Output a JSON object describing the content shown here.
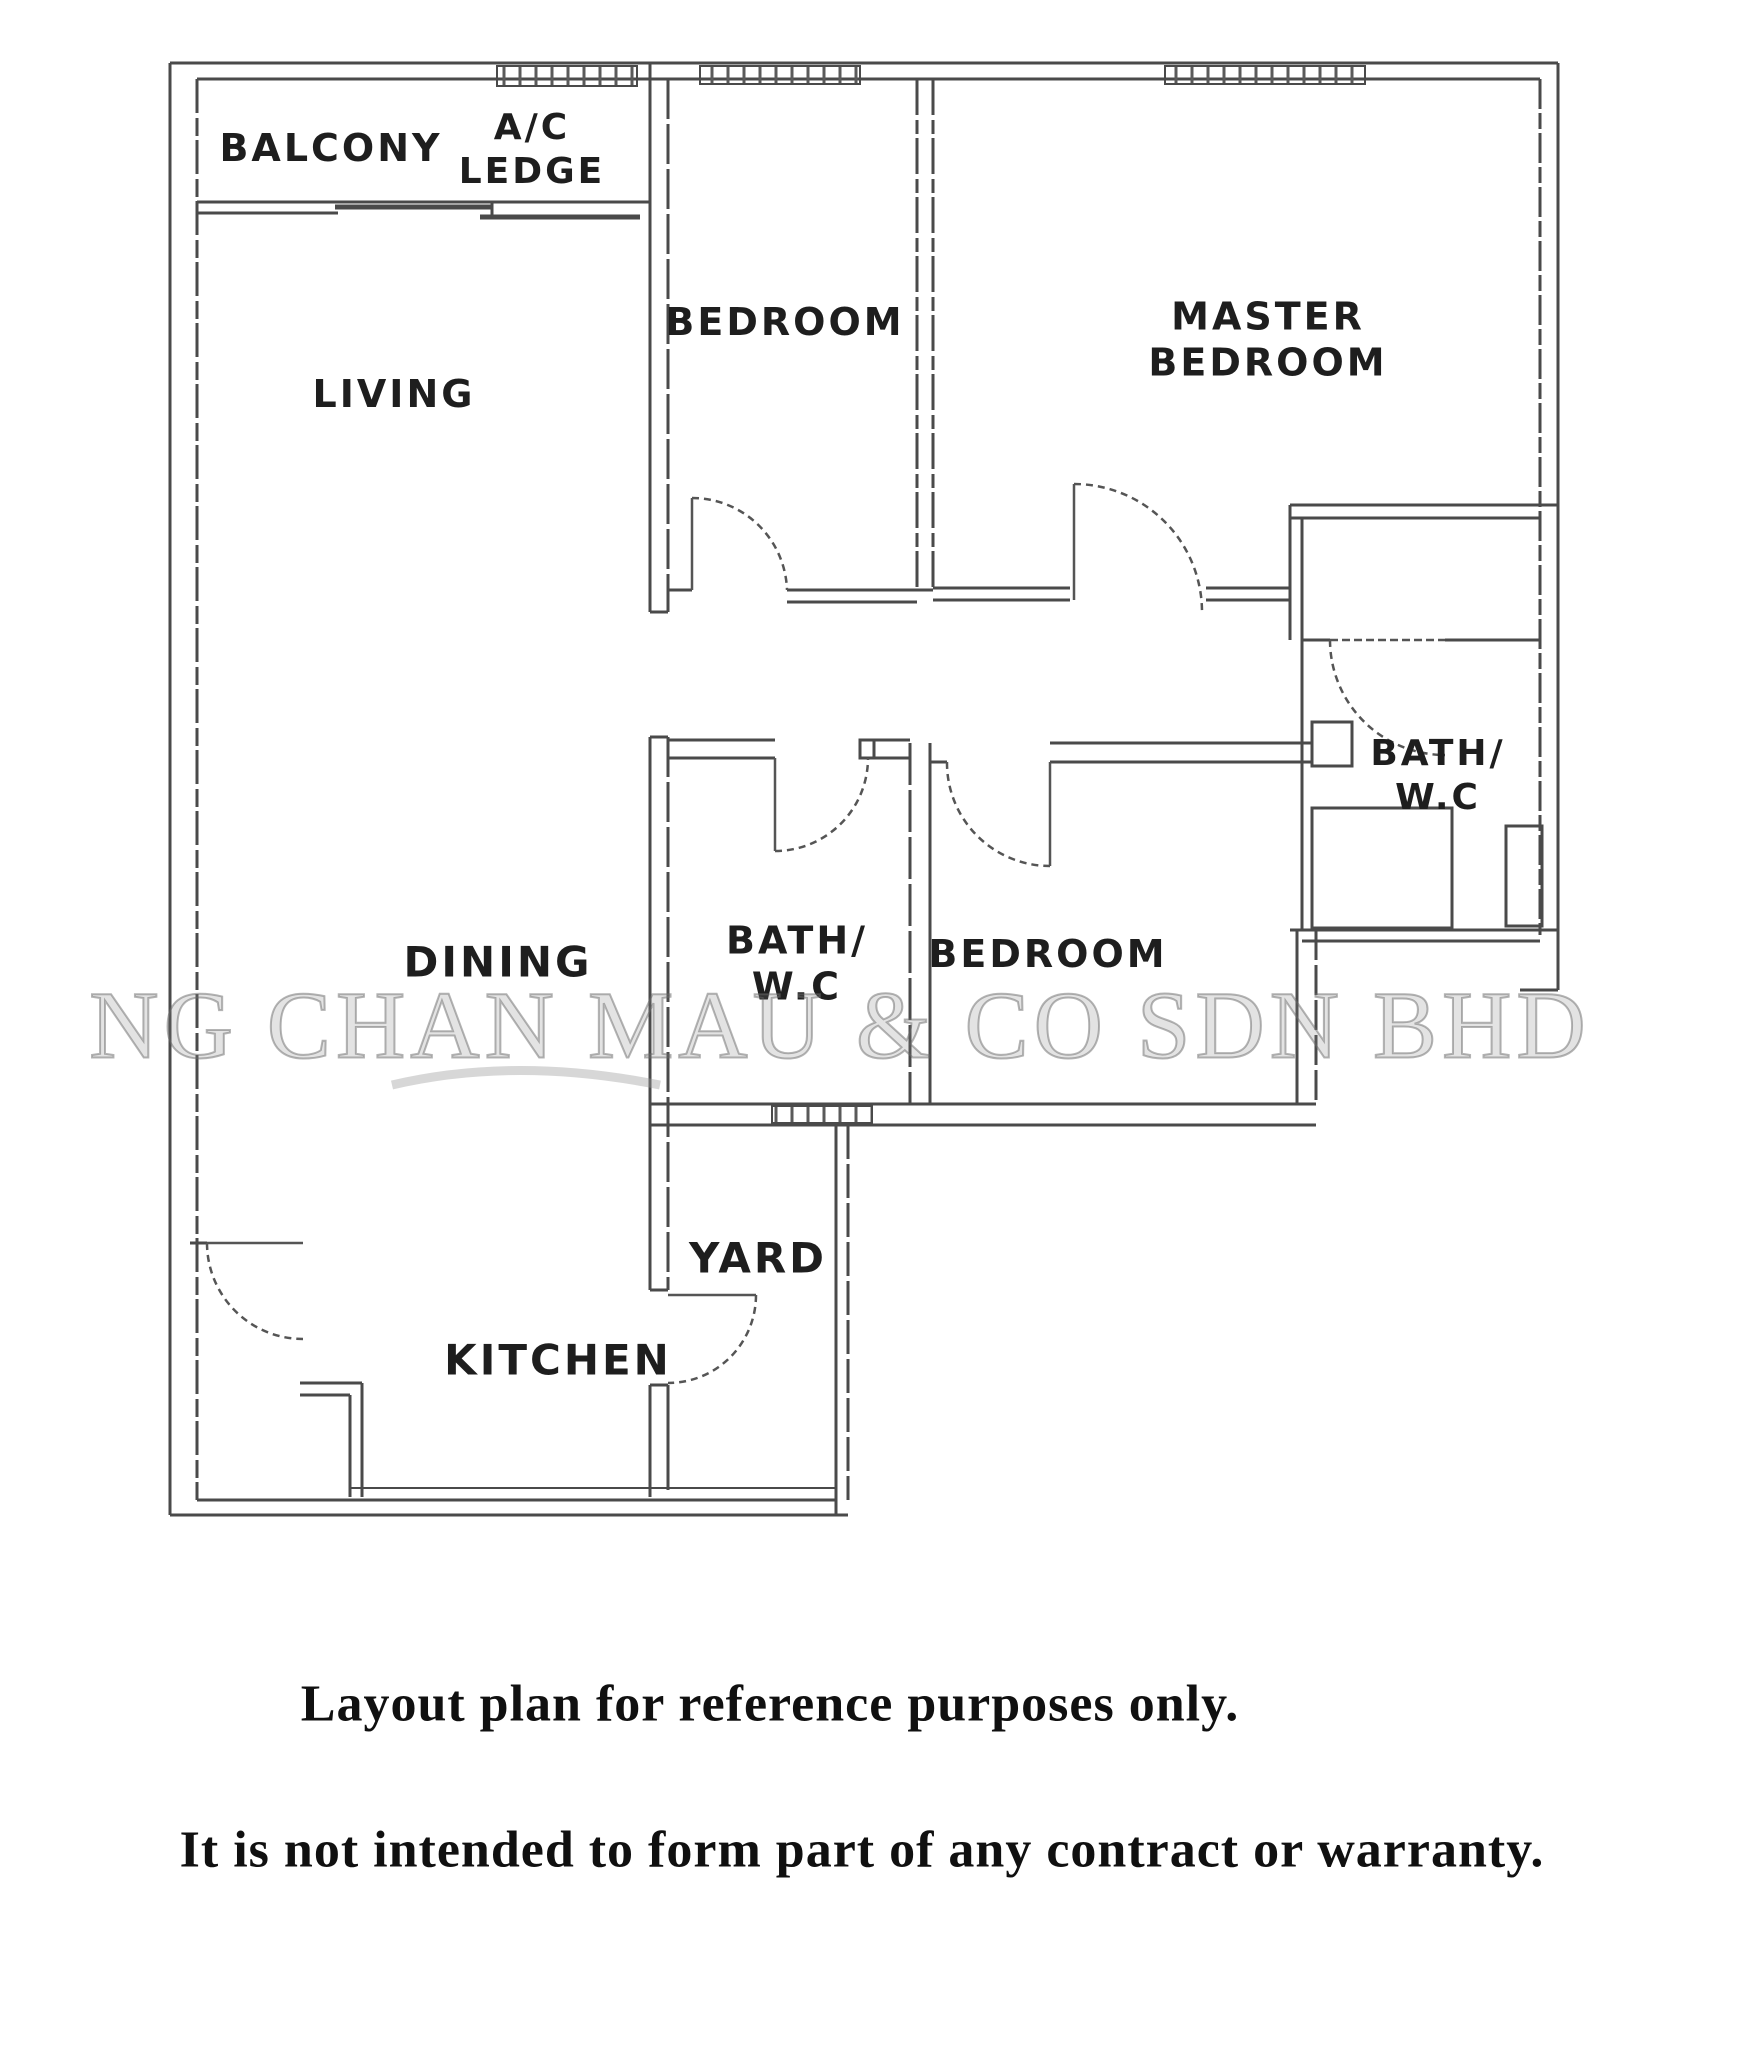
{
  "rooms": {
    "balcony": "BALCONY",
    "ac_ledge_l1": "A/C",
    "ac_ledge_l2": "LEDGE",
    "living": "LIVING",
    "bedroom_top": "BEDROOM",
    "master_l1": "MASTER",
    "master_l2": "BEDROOM",
    "bath_center_l1": "BATH/",
    "bath_center_l2": "W.C",
    "bedroom_mid": "BEDROOM",
    "bath_master_l1": "BATH/",
    "bath_master_l2": "W.C",
    "dining": "DINING",
    "yard": "YARD",
    "kitchen": "KITCHEN"
  },
  "watermark": "NG CHAN MAU & CO SDN BHD",
  "captions": {
    "line1": "Layout plan for reference purposes only.",
    "line2": "It is not intended to form part of any contract or warranty."
  },
  "colors": {
    "wall_ink": "#4a4a4a",
    "watermark_gray": "#808080",
    "caption_ink": "#101010"
  }
}
